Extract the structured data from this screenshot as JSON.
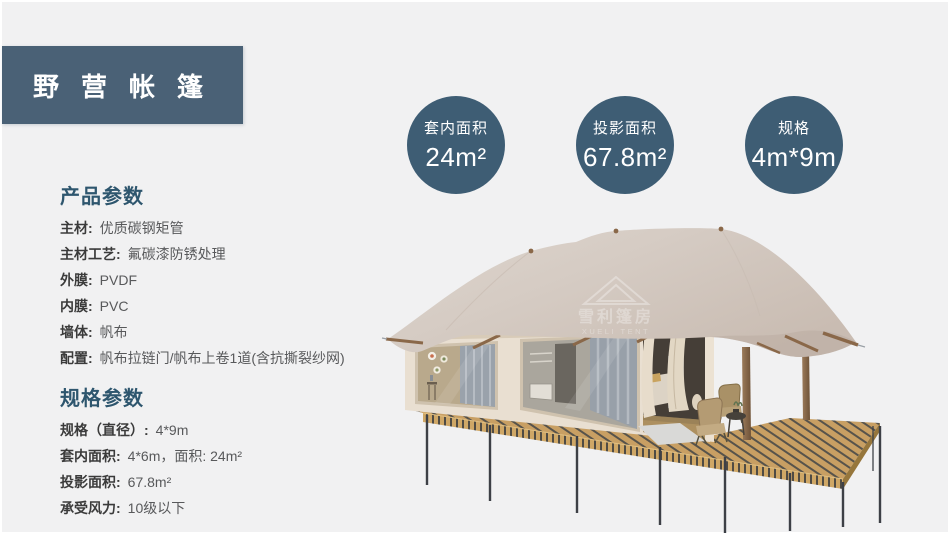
{
  "page": {
    "background": "#f1f1f2",
    "accent_box": "#4a6176",
    "accent_circle": "#3e5d74",
    "heading_color": "#2e566e"
  },
  "header": {
    "title": "野营帐篷"
  },
  "badges": [
    {
      "label": "套内面积",
      "value": "24m²"
    },
    {
      "label": "投影面积",
      "value": "67.8m²"
    },
    {
      "label": "规格",
      "value": "4m*9m"
    }
  ],
  "product_params": {
    "heading": "产品参数",
    "items": [
      {
        "label": "主材:",
        "value": "优质碳钢矩管"
      },
      {
        "label": "主材工艺:",
        "value": "氟碳漆防锈处理"
      },
      {
        "label": "外膜:",
        "value": "PVDF"
      },
      {
        "label": "内膜:",
        "value": "PVC"
      },
      {
        "label": "墙体:",
        "value": "帆布"
      },
      {
        "label": "配置:",
        "value": "帆布拉链门/帆布上卷1道(含抗撕裂纱网)"
      }
    ]
  },
  "spec_params": {
    "heading": "规格参数",
    "items": [
      {
        "label": "规格（直径）:",
        "value": "4*9m"
      },
      {
        "label": "套内面积:",
        "value": "4*6m，面积: 24m²"
      },
      {
        "label": "投影面积:",
        "value": "67.8m²"
      },
      {
        "label": "承受风力:",
        "value": "10级以下"
      }
    ]
  },
  "watermark": {
    "cn": "雪利篷房",
    "en": "XUELI TENT"
  }
}
